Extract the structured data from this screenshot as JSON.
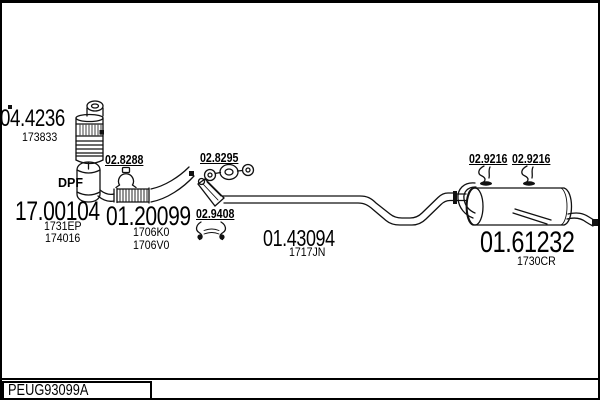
{
  "page": {
    "background": "#ffffff",
    "line_color": "#111111"
  },
  "parts": [
    {
      "code": "04.4236",
      "refs": [
        "173833"
      ]
    },
    {
      "code": "17.00104",
      "refs": [
        "1731EP",
        "174016"
      ]
    },
    {
      "code": "01.20099",
      "refs": [
        "1706K0",
        "1706V0"
      ]
    },
    {
      "code": "01.43094",
      "refs": [
        "1717JN"
      ]
    },
    {
      "code": "01.61232",
      "refs": [
        "1730CR"
      ]
    }
  ],
  "accessories": [
    {
      "code": "02.8288",
      "icon": "clamp-icon"
    },
    {
      "code": "02.8295",
      "icon": "gasket-icon"
    },
    {
      "code": "02.9408",
      "icon": "double-hanger-icon"
    },
    {
      "code": "02.9216",
      "icon": "rubber-hanger-icon"
    },
    {
      "code": "02.9216",
      "icon": "rubber-hanger-icon"
    }
  ],
  "labels": {
    "dpf": "DPF"
  },
  "footer": {
    "catalog_ref": "PEUG93099A"
  }
}
